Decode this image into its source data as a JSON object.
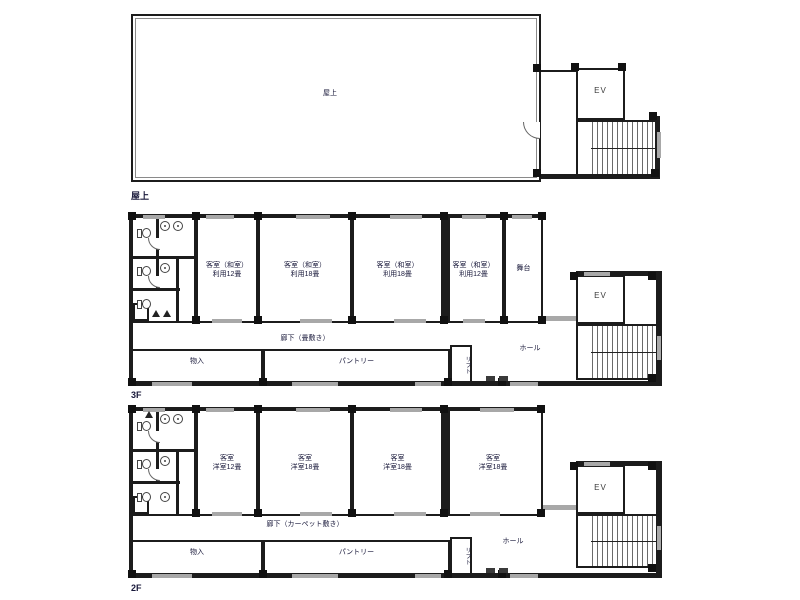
{
  "colors": {
    "wall": "#1c1c1c",
    "window": "#a8a8a8",
    "ink": "#18183a",
    "background": "#ffffff"
  },
  "roof": {
    "room_label": "屋上",
    "floor_label": "屋上",
    "ev": "EV"
  },
  "f3": {
    "floor_label": "3F",
    "room1": "客室（和室）\n利用12畳",
    "room2": "客室（和室）\n利用18畳",
    "room3": "客室（和室）\n利用18畳",
    "room4": "客室（和室）\n利用12畳",
    "stage": "舞台",
    "corridor": "廊下（畳敷き）",
    "storage": "物入",
    "pantry": "パントリー",
    "hall": "ホール",
    "lift": "リフト",
    "ev": "EV"
  },
  "f2": {
    "floor_label": "2F",
    "room1": "客室\n洋室12畳",
    "room2": "客室\n洋室18畳",
    "room3": "客室\n洋室18畳",
    "room4": "客室\n洋室18畳",
    "corridor": "廊下（カーペット敷き）",
    "storage": "物入",
    "pantry": "パントリー",
    "hall": "ホール",
    "lift": "リフト",
    "ev": "EV"
  }
}
